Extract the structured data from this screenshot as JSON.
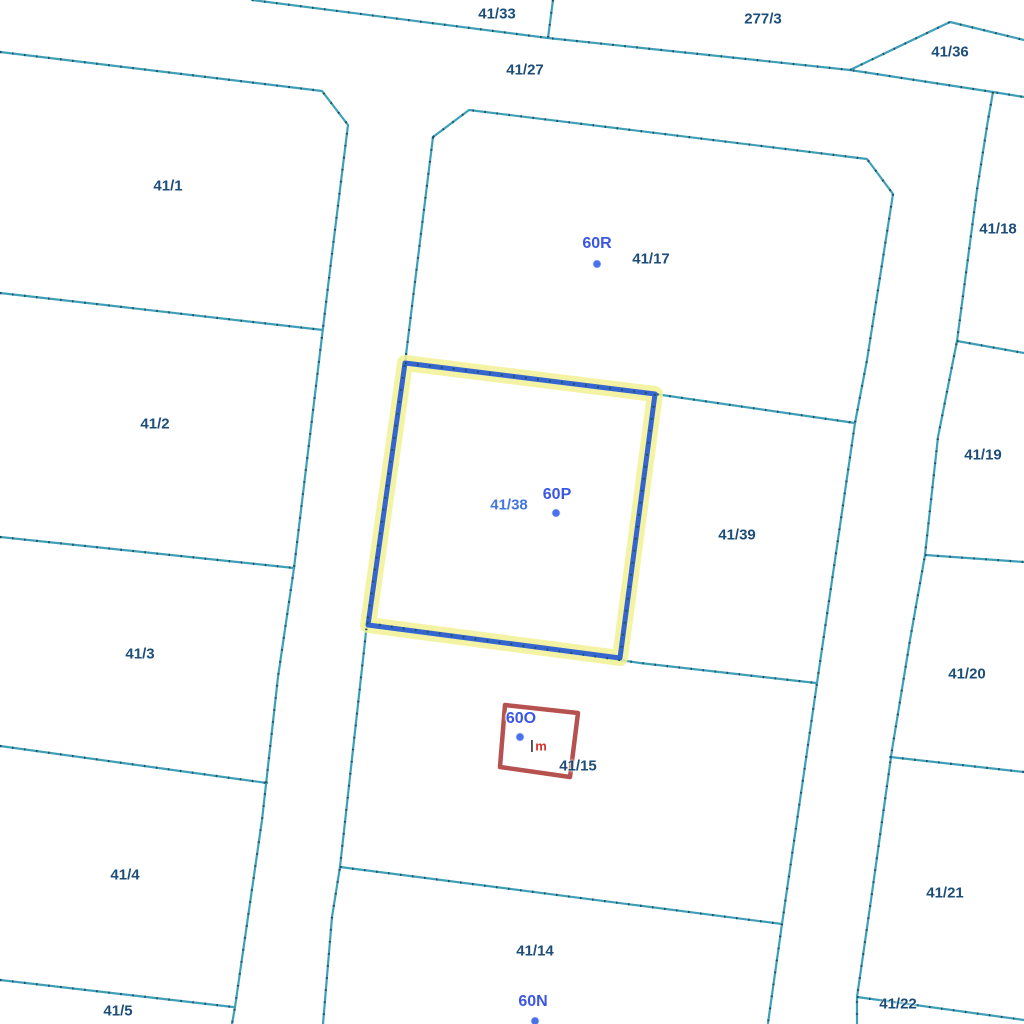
{
  "colors": {
    "background": "#ffffff",
    "boundary": "#3da0b8",
    "boundary_tick": "#1e4f63",
    "parcel_label": "#1d4e79",
    "building_label": "#3b57e3",
    "selected_label": "#4477de",
    "selected_outline": "#3565cf",
    "selected_halo": "#f1f193",
    "building_outline_red": "#b5514e",
    "annotation_red": "#d8312f",
    "marker_dot": "#4a72ec"
  },
  "selection": {
    "parcel": "41/38",
    "building_red_outline": "60O"
  },
  "labels": [
    {
      "id": "parcel-label-41-33",
      "text": "41/33",
      "type": "parcel",
      "x": 497,
      "y": 14
    },
    {
      "id": "parcel-label-277-3",
      "text": "277/3",
      "type": "parcel",
      "x": 763,
      "y": 19
    },
    {
      "id": "parcel-label-41-36",
      "text": "41/36",
      "type": "parcel",
      "x": 950,
      "y": 52
    },
    {
      "id": "parcel-label-41-27",
      "text": "41/27",
      "type": "parcel",
      "x": 525,
      "y": 70
    },
    {
      "id": "parcel-label-41-1",
      "text": "41/1",
      "type": "parcel",
      "x": 168,
      "y": 186
    },
    {
      "id": "building-label-60R",
      "text": "60R",
      "type": "building",
      "x": 597,
      "y": 244
    },
    {
      "id": "parcel-label-41-17",
      "text": "41/17",
      "type": "parcel",
      "x": 651,
      "y": 259
    },
    {
      "id": "parcel-label-41-18",
      "text": "41/18",
      "type": "parcel",
      "x": 998,
      "y": 229
    },
    {
      "id": "parcel-label-41-2",
      "text": "41/2",
      "type": "parcel",
      "x": 155,
      "y": 424
    },
    {
      "id": "parcel-label-41-19",
      "text": "41/19",
      "type": "parcel",
      "x": 983,
      "y": 455
    },
    {
      "id": "selected-parcel-label-41-38",
      "text": "41/38",
      "type": "selected",
      "x": 509,
      "y": 505
    },
    {
      "id": "building-label-60P",
      "text": "60P",
      "type": "building",
      "x": 557,
      "y": 495
    },
    {
      "id": "parcel-label-41-39",
      "text": "41/39",
      "type": "parcel",
      "x": 737,
      "y": 535
    },
    {
      "id": "parcel-label-41-3",
      "text": "41/3",
      "type": "parcel",
      "x": 140,
      "y": 654
    },
    {
      "id": "parcel-label-41-20",
      "text": "41/20",
      "type": "parcel",
      "x": 967,
      "y": 674
    },
    {
      "id": "building-label-60O",
      "text": "60O",
      "type": "building",
      "x": 521,
      "y": 719
    },
    {
      "id": "annotation-vbar",
      "text": "|",
      "type": "vbar",
      "x": 532,
      "y": 745
    },
    {
      "id": "annotation-m",
      "text": "m",
      "type": "note",
      "x": 541,
      "y": 746
    },
    {
      "id": "parcel-label-41-15",
      "text": "41/15",
      "type": "parcel",
      "x": 578,
      "y": 766
    },
    {
      "id": "parcel-label-41-4",
      "text": "41/4",
      "type": "parcel",
      "x": 125,
      "y": 875
    },
    {
      "id": "parcel-label-41-21",
      "text": "41/21",
      "type": "parcel",
      "x": 945,
      "y": 893
    },
    {
      "id": "parcel-label-41-14",
      "text": "41/14",
      "type": "parcel",
      "x": 535,
      "y": 951
    },
    {
      "id": "building-label-60N",
      "text": "60N",
      "type": "building",
      "x": 533,
      "y": 1002
    },
    {
      "id": "parcel-label-41-5",
      "text": "41/5",
      "type": "parcel",
      "x": 118,
      "y": 1011
    },
    {
      "id": "parcel-label-41-22",
      "text": "41/22",
      "type": "parcel",
      "x": 898,
      "y": 1004
    }
  ],
  "markers": [
    {
      "id": "building-marker-60R",
      "x": 597,
      "y": 264
    },
    {
      "id": "building-marker-60P",
      "x": 556,
      "y": 513
    },
    {
      "id": "building-marker-60O",
      "x": 520,
      "y": 737
    },
    {
      "id": "building-marker-60N",
      "x": 535,
      "y": 1021
    }
  ]
}
